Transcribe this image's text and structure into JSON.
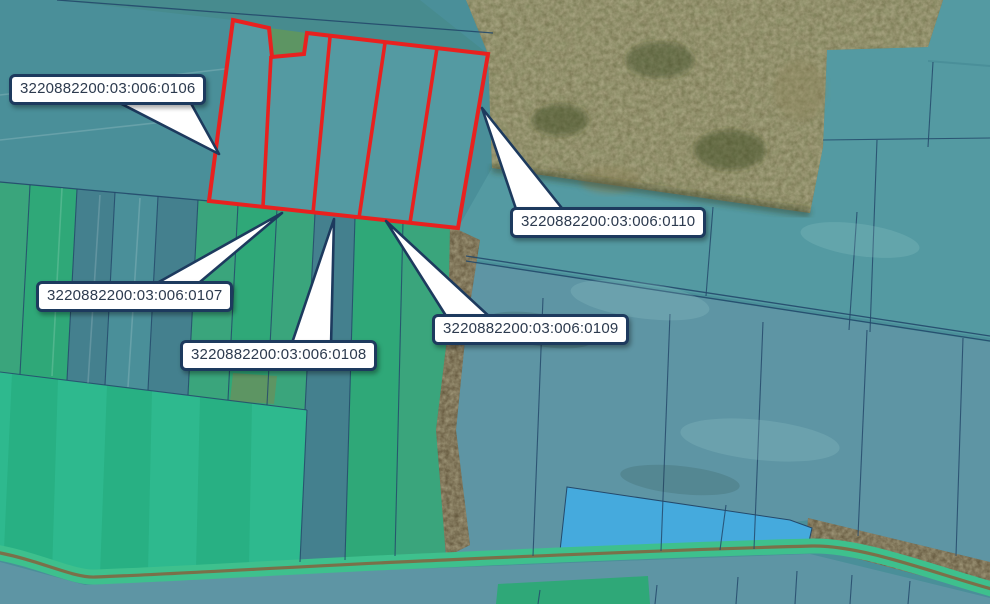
{
  "map": {
    "callouts": [
      {
        "label": "3220882200:03:006:0106"
      },
      {
        "label": "3220882200:03:006:0107"
      },
      {
        "label": "3220882200:03:006:0108"
      },
      {
        "label": "3220882200:03:006:0109"
      },
      {
        "label": "3220882200:03:006:0110"
      }
    ]
  },
  "colors": {
    "teal_a": "#4a8f99",
    "teal_b": "#478b8e",
    "teal_c": "#549aa2",
    "teal_d": "#5e95a4",
    "teal_e": "#44808e",
    "green_a": "#3aa57c",
    "green_b": "#2fa878",
    "green_c": "#5d9563",
    "bright_green_a": "#2eb98e",
    "bright_green_b": "#28b083",
    "road_green": "#3ec08d",
    "blue_parcel": "#45aadd",
    "forest_base": "#6e6a46",
    "brown_band": "#5f5339",
    "dirt": "#7d6b46",
    "boundary": "#24496b",
    "red_outline": "#e8211f",
    "callout_border": "#1d3a5e",
    "callout_text": "#2c3a4e",
    "callout_bg": "#ffffff"
  }
}
